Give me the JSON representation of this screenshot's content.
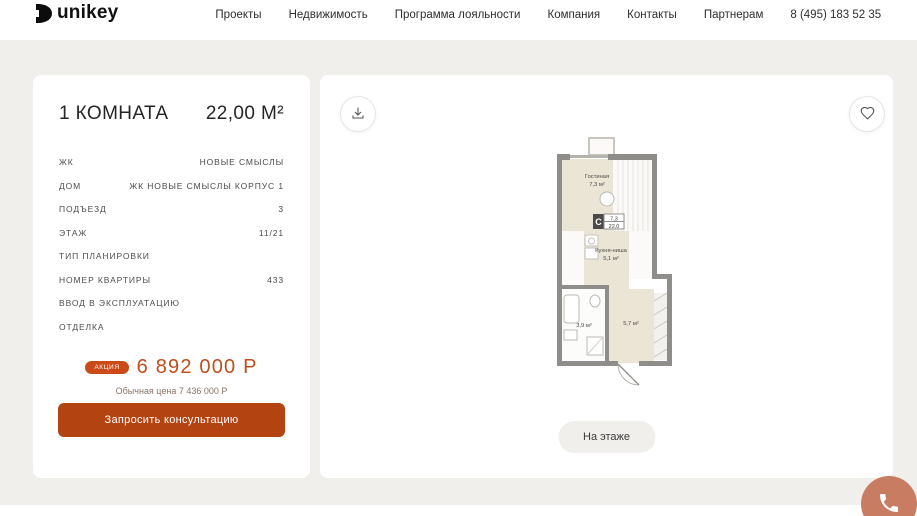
{
  "header": {
    "logo_text": "unikey",
    "nav": [
      {
        "label": "Проекты"
      },
      {
        "label": "Недвижимость"
      },
      {
        "label": "Программа лояльности"
      },
      {
        "label": "Компания"
      },
      {
        "label": "Контакты"
      },
      {
        "label": "Партнерам"
      }
    ],
    "phone": "8 (495) 183 52 35",
    "city": "Москва"
  },
  "apartment": {
    "rooms_title": "1 КОМНАТА",
    "area_title": "22,00 М²",
    "details": [
      {
        "label": "ЖК",
        "value": "НОВЫЕ СМЫСЛЫ"
      },
      {
        "label": "ДОМ",
        "value": "ЖК НОВЫЕ СМЫСЛЫ КОРПУС 1"
      },
      {
        "label": "ПОДЪЕЗД",
        "value": "3"
      },
      {
        "label": "ЭТАЖ",
        "value": "11/21"
      },
      {
        "label": "ТИП ПЛАНИРОВКИ",
        "value": ""
      },
      {
        "label": "НОМЕР КВАРТИРЫ",
        "value": "433"
      },
      {
        "label": "ВВОД В ЭКСПЛУАТАЦИЮ",
        "value": ""
      },
      {
        "label": "ОТДЕЛКА",
        "value": ""
      }
    ],
    "price": {
      "badge": "АКЦИЯ",
      "current": "6 892 000 Р",
      "old_label": "Обычная цена 7 436 000 Р"
    },
    "cta_label": "Запросить консультацию"
  },
  "plan": {
    "floor_button_label": "На этаже",
    "living_name": "Гостиная",
    "living_area": "7,3 м²",
    "kitchen_name": "Кухня-ниша",
    "kitchen_area": "5,1 м²",
    "bathroom_area": "3,9 м²",
    "hall_area": "5,7 м²",
    "info_letter": "С",
    "info_area_living": "7,3",
    "info_area_total": "22,0"
  },
  "icons": {
    "download": "arrow-down-to-tray",
    "favorite": "heart-outline",
    "city": "location-pin",
    "fab": "phone-handset"
  },
  "colors": {
    "accent": "#bf4e1d",
    "badge_bg": "#cb4a17",
    "cta_bg": "#b44312",
    "phone_fab_bg": "#c87c62",
    "page_bg": "#f1efec"
  }
}
